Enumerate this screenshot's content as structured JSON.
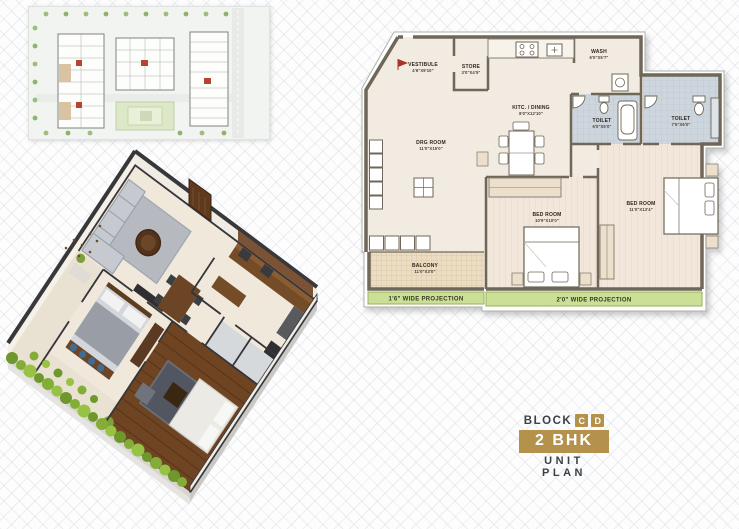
{
  "floor_plan": {
    "rooms": [
      {
        "id": "vestibule",
        "label": "VESTIBULE",
        "dims": "4'6\"X9'10\""
      },
      {
        "id": "store",
        "label": "STORE",
        "dims": "3'0\"X4'5\""
      },
      {
        "id": "kitchen_dining",
        "label": "KITC. / DINING",
        "dims": "8'0\"X12'10\""
      },
      {
        "id": "wash",
        "label": "WASH",
        "dims": "6'0\"X5'7\""
      },
      {
        "id": "toilet_1",
        "label": "TOILET",
        "dims": "6'0\"X5'0\""
      },
      {
        "id": "toilet_2",
        "label": "TOILET",
        "dims": "7'5\"X6'0\""
      },
      {
        "id": "drawing_room",
        "label": "DRG ROOM",
        "dims": "11'0\"X15'0\""
      },
      {
        "id": "bed_room_1",
        "label": "BED ROOM",
        "dims": "10'9\"X10'0\""
      },
      {
        "id": "bed_room_2",
        "label": "BED ROOM",
        "dims": "11'0\"X13'4\""
      },
      {
        "id": "balcony",
        "label": "BALCONY",
        "dims": "11'0\"X3'0\""
      }
    ],
    "projections": [
      {
        "label": "1'6\" WIDE PROJECTION"
      },
      {
        "label": "2'0\" WIDE PROJECTION"
      }
    ]
  },
  "title_block": {
    "block_label": "BLOCK",
    "block_letters": [
      "C",
      "D"
    ],
    "unit_type": "2 BHK",
    "plan_label": "UNIT PLAN"
  },
  "palette": {
    "accent_gold": "#b5924c",
    "text_dark": "#3b4148",
    "projection_green": "#ccdf97",
    "wall_taupe": "#6f6758",
    "floor_cream": "#f1ebe1",
    "toilet_blue": "#cdd5dd",
    "wood_brown": "#6f4422",
    "hedge_green": "#7ca331",
    "marker_red": "#a93327"
  }
}
